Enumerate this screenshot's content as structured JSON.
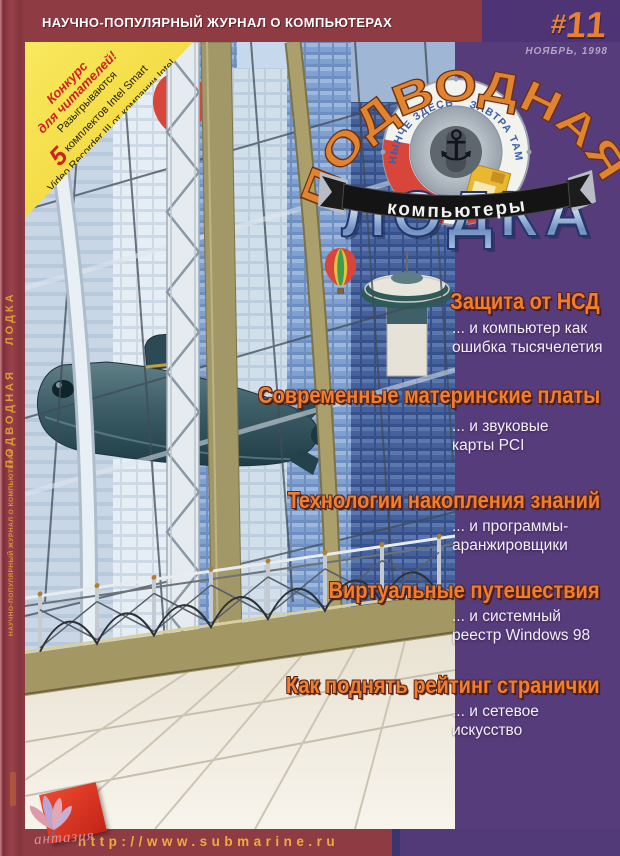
{
  "masthead": {
    "tagline": "НАУЧНО-ПОПУЛЯРНЫЙ ЖУРНАЛ О КОМПЬЮТЕРАХ",
    "issue_prefix": "#",
    "issue_number": "11",
    "issue_date": "НОЯБРЬ, 1998"
  },
  "logo": {
    "title_top": "ПОДВОДНАЯ",
    "title_bottom": "ЛОДКА",
    "ribbon": "компьютеры",
    "motto_left": "НЫНЧЕ ЗДЕСЬ",
    "motto_right": "ЗАВТРА ТАМ",
    "anchor_icon": "⚓"
  },
  "contest_sticker": {
    "line1": "Конкурс",
    "line2": "для читателей!",
    "line3": "Разыгрываются",
    "count": "5",
    "line4": "комплектов Intel Smart",
    "line5": "Video Recorder III от компании Intel",
    "line6": "Условия на стр. 47"
  },
  "spine": {
    "title": "ПОДВОДНАЯ ЛОДКА",
    "tagline": "НАУЧНО-ПОПУЛЯРНЫЙ ЖУРНАЛ О КОМПЬЮТЕРАХ"
  },
  "headlines": [
    {
      "title": "Защита от НСД",
      "subtitle_lines": [
        "... и компьютер как",
        "ошибка тысячелетия"
      ]
    },
    {
      "title": "Современные материнские платы",
      "subtitle_lines": [
        "... и звуковые",
        "карты PCI"
      ]
    },
    {
      "title": "Технологии накопления знаний",
      "subtitle_lines": [
        "... и программы-",
        "аранжировщики"
      ]
    },
    {
      "title": "Виртуальные путешествия",
      "subtitle_lines": [
        "... и системный",
        "реестр Windows 98"
      ]
    },
    {
      "title": "Как поднять рейтинг странички",
      "subtitle_lines": [
        "... и сетевое",
        "искусство"
      ]
    }
  ],
  "footer": {
    "url": "http://www.submarine.ru",
    "publisher_script": "антазия"
  },
  "colors": {
    "maroon": "#8e3b44",
    "purple": "#573c7c",
    "sticker_yellow": "#f6e045",
    "headline_orange": "#ef7f2e",
    "url_orange": "#f2aa3c"
  }
}
